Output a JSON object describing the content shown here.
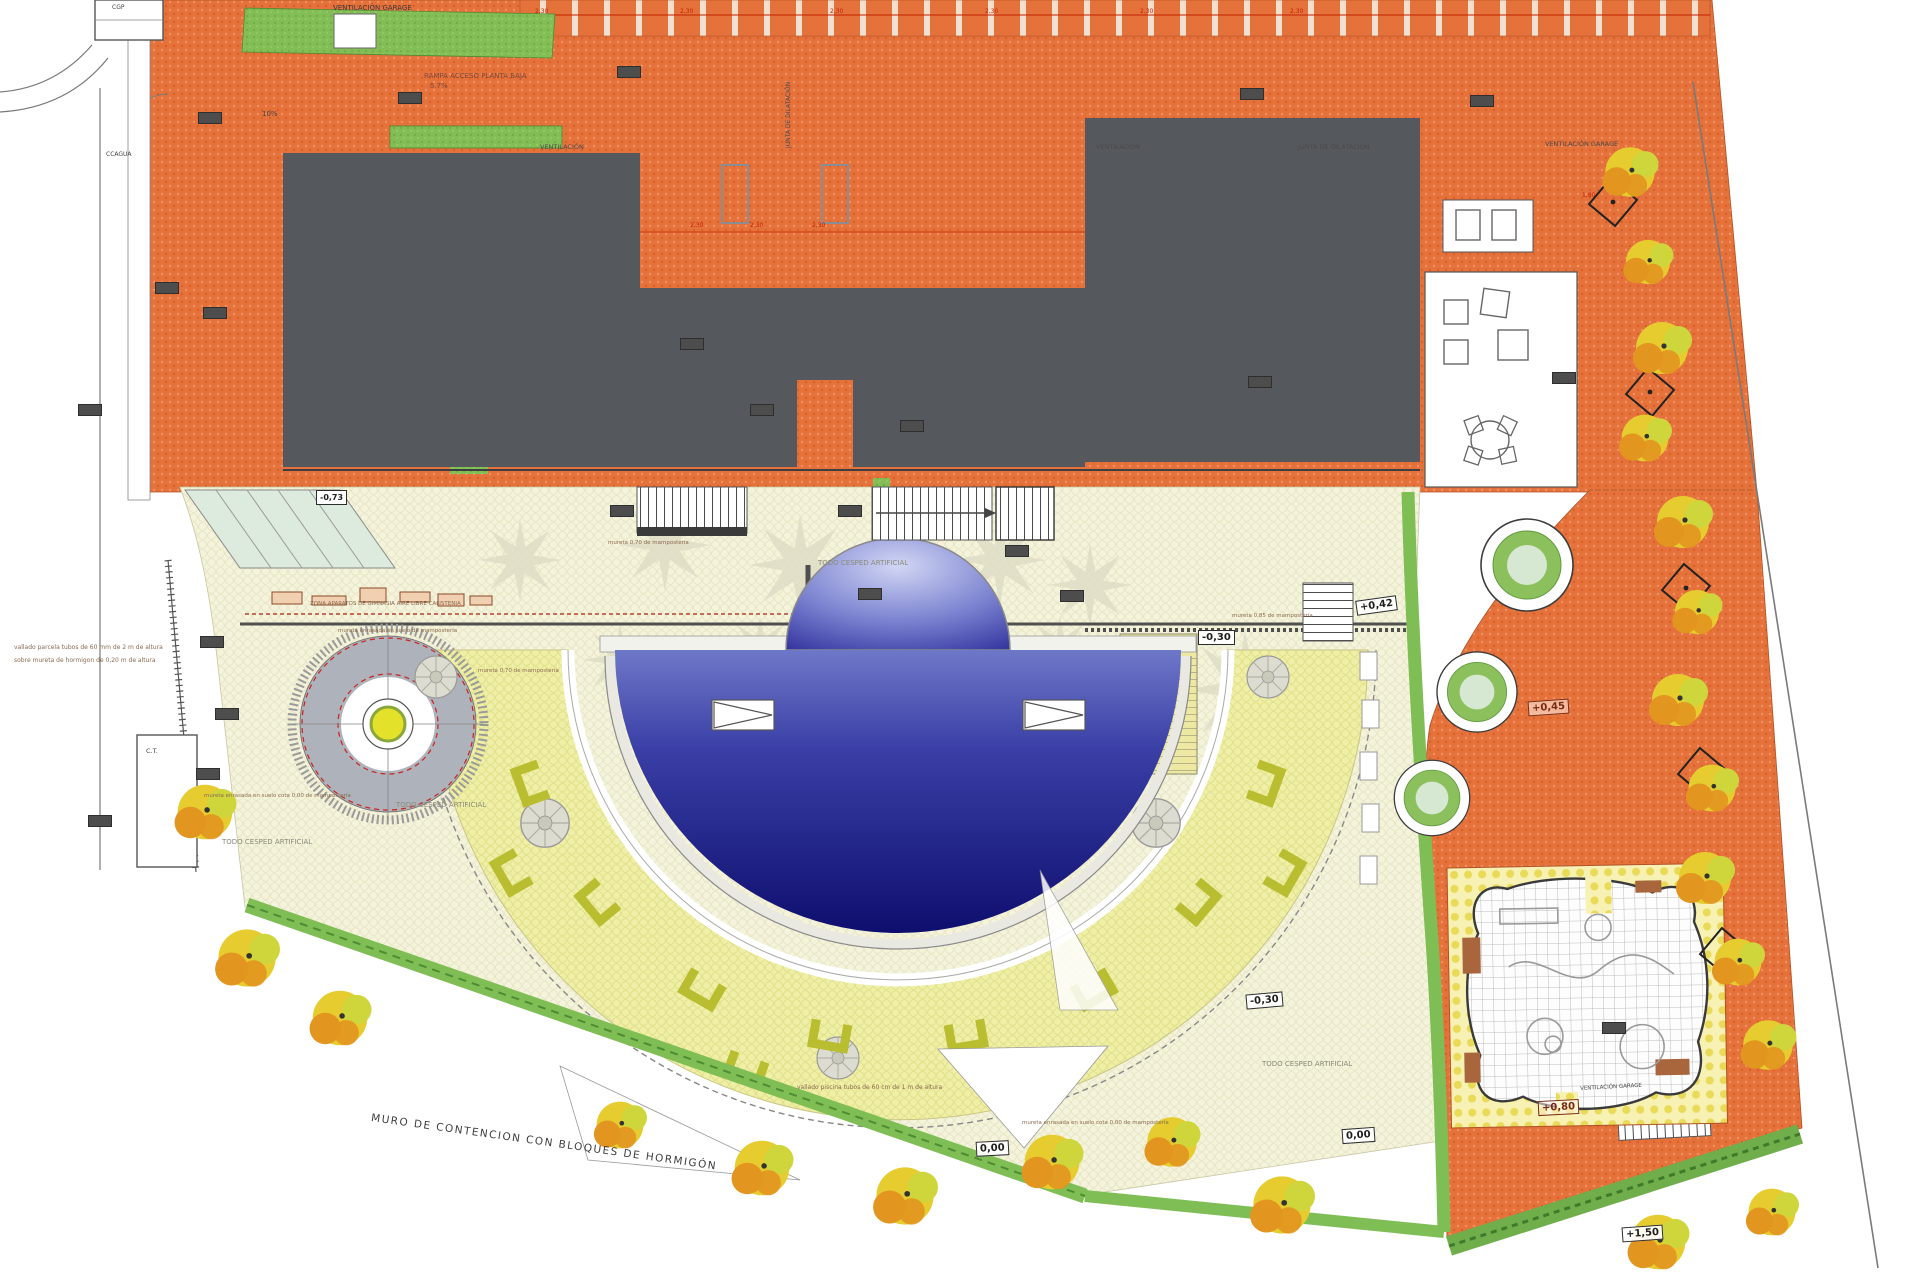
{
  "drawing": {
    "labels": {
      "ventilacion_garage_top": "VENTILACIÓN GARAGE",
      "ventilacion_garage_right": "VENTILACIÓN GARAGE",
      "ventilacion_garage_bottom": "VENTILACIÓN GARAGE",
      "rampa": "RAMPA ACCESO PLANTA BAJA",
      "rampa_slope": "5.7%",
      "ramp_10": "10%",
      "ventilacion_a": "VENTILACIÓN",
      "ventilacion_b": "VENTILACIÓN",
      "junta_h": "JUNTA DE DILATACIÓN",
      "junta_v": "JUNTA DE DILATACIÓN",
      "ccagua": "CCAGUA",
      "cgp": "CGP",
      "ct": "C.T.",
      "todo_cesped": "TODO CESPED ARTIFICIAL",
      "zona_aparatos": "ZONA APARATOS DE GIMNASIA AIRE LIBRE CALISTENIA",
      "mureta_enrasada": "mureta enrasada en suelo de mampostería",
      "mureta_070": "mureta 0,70 de mampostería",
      "mureta_085": "mureta 0,85 de mampostería",
      "mureta_cota": "mureta enrasada en suelo cota 0,00 de mampostería",
      "vallado_parcela_1": "vallado parcela tubos de 60 mm de 2 m de altura",
      "vallado_parcela_2": "sobre mureta de hormigon de 0,20 m de altura",
      "vallado_piscina": "vallado piscina tubos de 60 cm de 1 m de altura",
      "muro": "MURO DE CONTENCION  CON BLOQUES DE HORMIGÓN"
    },
    "levels": {
      "neg073": "-0,73",
      "neg030": "-0,30",
      "zero": "0,00",
      "p042": "+0,42",
      "p045": "+0,45",
      "p080": "+0,80",
      "p150": "+1,50"
    },
    "dims": {
      "d230": "2,30",
      "d180": "1,80"
    },
    "colors": {
      "paving_orange": "#E5713B",
      "building_gray": "#55585D",
      "plaza_cream": "#F4F3DB",
      "pool_ring_yellow": "#EFEFA8",
      "pool_dark": "#10107A",
      "pool_light": "#AEB6E8",
      "green": "#7FBE55",
      "bench_green": "#B9BD30",
      "tree_yellow": "#E6CC2E",
      "tree_orange": "#E2951F",
      "dim_red": "#C42200"
    }
  }
}
